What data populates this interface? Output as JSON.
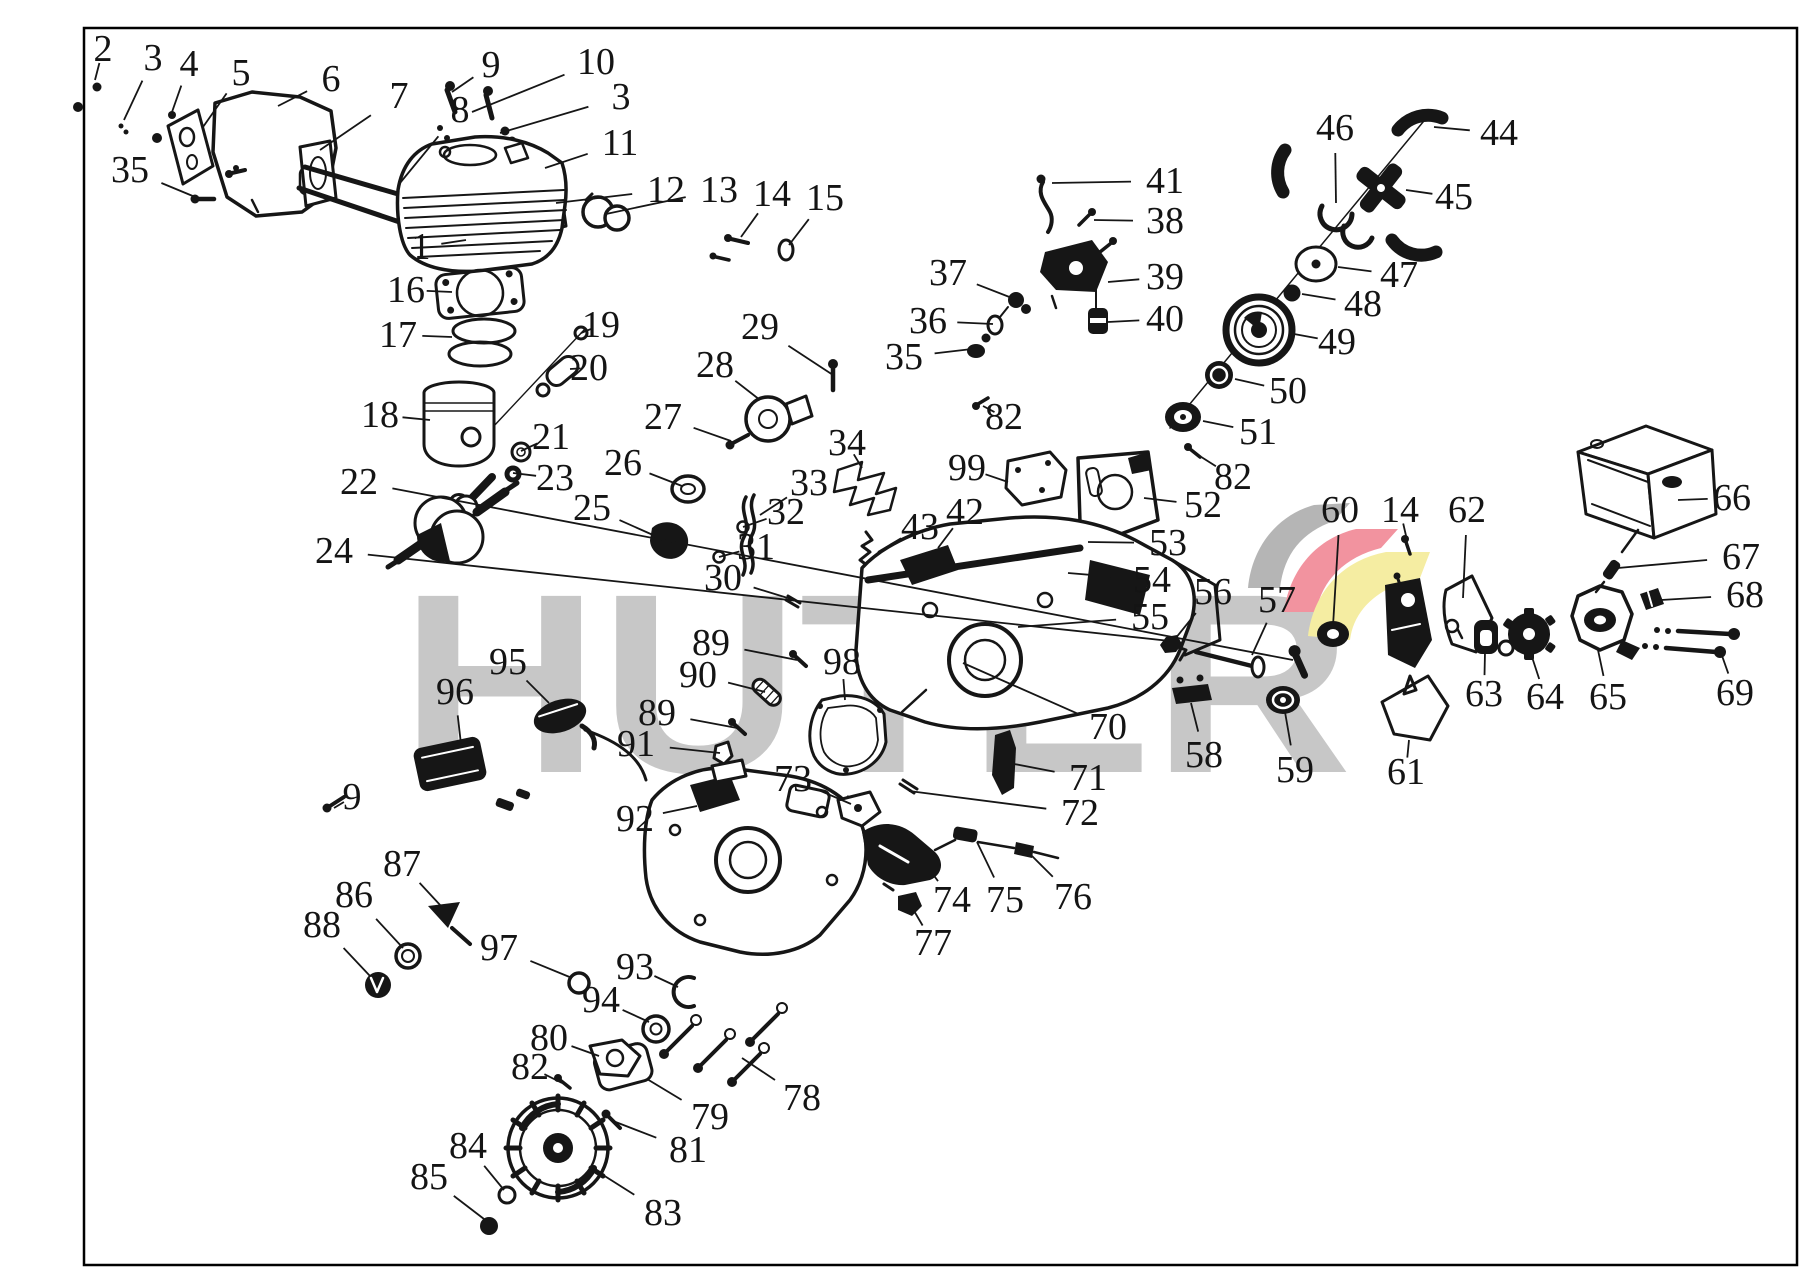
{
  "watermark": {
    "text": "HUTER",
    "letter_color": "#c7c7c7",
    "logo_gray": "#b5b5b5",
    "logo_red": "#f2939f",
    "logo_yellow": "#f5eda2"
  },
  "frame_color": "#000000",
  "line_color": "#161616",
  "callouts": [
    {
      "n": "2",
      "x": 103,
      "y": 49,
      "tx": 95,
      "ty": 80
    },
    {
      "n": "3",
      "x": 153,
      "y": 58,
      "tx": 124,
      "ty": 120
    },
    {
      "n": "4",
      "x": 189,
      "y": 64,
      "tx": 172,
      "ty": 112
    },
    {
      "n": "5",
      "x": 241,
      "y": 73,
      "tx": 203,
      "ty": 127
    },
    {
      "n": "6",
      "x": 331,
      "y": 79,
      "tx": 278,
      "ty": 106
    },
    {
      "n": "7",
      "x": 399,
      "y": 96,
      "tx": 320,
      "ty": 150
    },
    {
      "n": "8",
      "x": 460,
      "y": 110,
      "tx": 400,
      "ty": 183
    },
    {
      "n": "9",
      "x": 491,
      "y": 65,
      "tx": 452,
      "ty": 92
    },
    {
      "n": "10",
      "x": 596,
      "y": 62,
      "tx": 472,
      "ty": 112
    },
    {
      "n": "3",
      "x": 621,
      "y": 97,
      "tx": 500,
      "ty": 133
    },
    {
      "n": "11",
      "x": 620,
      "y": 143,
      "tx": 545,
      "ty": 168
    },
    {
      "n": "12",
      "x": 666,
      "y": 190,
      "tx": 556,
      "ty": 203
    },
    {
      "n": "13",
      "x": 719,
      "y": 190,
      "tx": 606,
      "ty": 214
    },
    {
      "n": "14",
      "x": 772,
      "y": 194,
      "tx": 741,
      "ty": 237
    },
    {
      "n": "15",
      "x": 825,
      "y": 198,
      "tx": 789,
      "ty": 245
    },
    {
      "n": "35",
      "x": 130,
      "y": 170,
      "tx": 200,
      "ty": 199
    },
    {
      "n": "1",
      "x": 421,
      "y": 247,
      "tx": 466,
      "ty": 240
    },
    {
      "n": "16",
      "x": 406,
      "y": 290,
      "tx": 452,
      "ty": 292
    },
    {
      "n": "17",
      "x": 398,
      "y": 335,
      "tx": 452,
      "ty": 337
    },
    {
      "n": "19",
      "x": 601,
      "y": 325,
      "tx": 581,
      "ty": 333
    },
    {
      "n": "20",
      "x": 589,
      "y": 368,
      "tx": 570,
      "ty": 369
    },
    {
      "n": "18",
      "x": 380,
      "y": 415,
      "tx": 430,
      "ty": 420
    },
    {
      "n": "21",
      "x": 551,
      "y": 437,
      "tx": 521,
      "ty": 451
    },
    {
      "n": "23",
      "x": 555,
      "y": 478,
      "tx": 513,
      "ty": 473
    },
    {
      "n": "22",
      "x": 359,
      "y": 482,
      "tx": 1293,
      "ty": 660
    },
    {
      "n": "24",
      "x": 334,
      "y": 551,
      "tx": 1170,
      "ty": 641
    },
    {
      "n": "25",
      "x": 592,
      "y": 508,
      "tx": 653,
      "ty": 535
    },
    {
      "n": "26",
      "x": 623,
      "y": 463,
      "tx": 682,
      "ty": 486
    },
    {
      "n": "27",
      "x": 663,
      "y": 417,
      "tx": 731,
      "ty": 441
    },
    {
      "n": "28",
      "x": 715,
      "y": 365,
      "tx": 760,
      "ty": 400
    },
    {
      "n": "29",
      "x": 760,
      "y": 327,
      "tx": 833,
      "ty": 375
    },
    {
      "n": "34",
      "x": 847,
      "y": 443,
      "tx": 862,
      "ty": 468
    },
    {
      "n": "33",
      "x": 809,
      "y": 483,
      "tx": 760,
      "ty": 515
    },
    {
      "n": "32",
      "x": 786,
      "y": 512,
      "tx": 743,
      "ty": 527
    },
    {
      "n": "31",
      "x": 756,
      "y": 547,
      "tx": 719,
      "ty": 557
    },
    {
      "n": "30",
      "x": 723,
      "y": 578,
      "tx": 791,
      "ty": 599
    },
    {
      "n": "43",
      "x": 920,
      "y": 527,
      "tx": 878,
      "ty": 552
    },
    {
      "n": "42",
      "x": 965,
      "y": 512,
      "tx": 938,
      "ty": 548
    },
    {
      "n": "37",
      "x": 948,
      "y": 273,
      "tx": 1012,
      "ty": 298
    },
    {
      "n": "36",
      "x": 928,
      "y": 321,
      "tx": 993,
      "ty": 324
    },
    {
      "n": "35",
      "x": 904,
      "y": 357,
      "tx": 972,
      "ty": 349
    },
    {
      "n": "41",
      "x": 1165,
      "y": 181,
      "tx": 1052,
      "ty": 183
    },
    {
      "n": "38",
      "x": 1165,
      "y": 221,
      "tx": 1094,
      "ty": 220
    },
    {
      "n": "39",
      "x": 1165,
      "y": 277,
      "tx": 1108,
      "ty": 282
    },
    {
      "n": "40",
      "x": 1165,
      "y": 319,
      "tx": 1108,
      "ty": 322
    },
    {
      "n": "82",
      "x": 1004,
      "y": 417,
      "tx": 983,
      "ty": 406
    },
    {
      "n": "99",
      "x": 967,
      "y": 468,
      "tx": 1008,
      "ty": 482
    },
    {
      "n": "46",
      "x": 1335,
      "y": 128,
      "tx": 1336,
      "ty": 203
    },
    {
      "n": "44",
      "x": 1499,
      "y": 133,
      "tx": 1434,
      "ty": 127
    },
    {
      "n": "45",
      "x": 1454,
      "y": 197,
      "tx": 1406,
      "ty": 190
    },
    {
      "n": "47",
      "x": 1399,
      "y": 275,
      "tx": 1338,
      "ty": 267
    },
    {
      "n": "48",
      "x": 1363,
      "y": 304,
      "tx": 1302,
      "ty": 294
    },
    {
      "n": "49",
      "x": 1337,
      "y": 342,
      "tx": 1294,
      "ty": 334
    },
    {
      "n": "50",
      "x": 1288,
      "y": 391,
      "tx": 1235,
      "ty": 379
    },
    {
      "n": "51",
      "x": 1258,
      "y": 432,
      "tx": 1203,
      "ty": 421
    },
    {
      "n": "82",
      "x": 1233,
      "y": 477,
      "tx": 1195,
      "ty": 453
    },
    {
      "n": "52",
      "x": 1203,
      "y": 505,
      "tx": 1144,
      "ty": 498
    },
    {
      "n": "53",
      "x": 1168,
      "y": 543,
      "tx": 1088,
      "ty": 542
    },
    {
      "n": "54",
      "x": 1152,
      "y": 580,
      "tx": 1068,
      "ty": 573
    },
    {
      "n": "55",
      "x": 1150,
      "y": 617,
      "tx": 1018,
      "ty": 627
    },
    {
      "n": "56",
      "x": 1213,
      "y": 592,
      "tx": 1175,
      "ty": 639
    },
    {
      "n": "57",
      "x": 1277,
      "y": 600,
      "tx": 1252,
      "ty": 655
    },
    {
      "n": "60",
      "x": 1340,
      "y": 510,
      "tx": 1333,
      "ty": 626
    },
    {
      "n": "14",
      "x": 1400,
      "y": 510,
      "tx": 1407,
      "ty": 540
    },
    {
      "n": "62",
      "x": 1467,
      "y": 510,
      "tx": 1463,
      "ty": 598
    },
    {
      "n": "66",
      "x": 1732,
      "y": 498,
      "tx": 1678,
      "ty": 500
    },
    {
      "n": "67",
      "x": 1741,
      "y": 557,
      "tx": 1618,
      "ty": 568
    },
    {
      "n": "68",
      "x": 1745,
      "y": 595,
      "tx": 1661,
      "ty": 600
    },
    {
      "n": "69",
      "x": 1735,
      "y": 693,
      "tx": 1720,
      "ty": 650
    },
    {
      "n": "63",
      "x": 1484,
      "y": 694,
      "tx": 1485,
      "ty": 652
    },
    {
      "n": "64",
      "x": 1545,
      "y": 697,
      "tx": 1532,
      "ty": 657
    },
    {
      "n": "65",
      "x": 1608,
      "y": 697,
      "tx": 1598,
      "ty": 650
    },
    {
      "n": "59",
      "x": 1295,
      "y": 770,
      "tx": 1285,
      "ty": 712
    },
    {
      "n": "61",
      "x": 1406,
      "y": 772,
      "tx": 1409,
      "ty": 740
    },
    {
      "n": "58",
      "x": 1204,
      "y": 755,
      "tx": 1191,
      "ty": 703
    },
    {
      "n": "70",
      "x": 1108,
      "y": 727,
      "tx": 963,
      "ty": 663
    },
    {
      "n": "71",
      "x": 1088,
      "y": 778,
      "tx": 1009,
      "ty": 763
    },
    {
      "n": "72",
      "x": 1080,
      "y": 813,
      "tx": 909,
      "ty": 791
    },
    {
      "n": "89",
      "x": 711,
      "y": 643,
      "tx": 797,
      "ty": 660
    },
    {
      "n": "90",
      "x": 698,
      "y": 675,
      "tx": 765,
      "ty": 692
    },
    {
      "n": "89",
      "x": 657,
      "y": 713,
      "tx": 737,
      "ty": 728
    },
    {
      "n": "91",
      "x": 636,
      "y": 744,
      "tx": 720,
      "ty": 753
    },
    {
      "n": "98",
      "x": 842,
      "y": 662,
      "tx": 845,
      "ty": 700
    },
    {
      "n": "95",
      "x": 508,
      "y": 662,
      "tx": 549,
      "ty": 703
    },
    {
      "n": "96",
      "x": 455,
      "y": 692,
      "tx": 461,
      "ty": 744
    },
    {
      "n": "9",
      "x": 352,
      "y": 797,
      "tx": 334,
      "ty": 808
    },
    {
      "n": "73",
      "x": 793,
      "y": 779,
      "tx": 851,
      "ty": 804
    },
    {
      "n": "92",
      "x": 635,
      "y": 819,
      "tx": 697,
      "ty": 806
    },
    {
      "n": "87",
      "x": 402,
      "y": 864,
      "tx": 441,
      "ty": 906
    },
    {
      "n": "86",
      "x": 354,
      "y": 895,
      "tx": 403,
      "ty": 948
    },
    {
      "n": "88",
      "x": 322,
      "y": 925,
      "tx": 370,
      "ty": 976
    },
    {
      "n": "97",
      "x": 499,
      "y": 948,
      "tx": 572,
      "ty": 978
    },
    {
      "n": "93",
      "x": 635,
      "y": 967,
      "tx": 678,
      "ty": 987
    },
    {
      "n": "94",
      "x": 601,
      "y": 1000,
      "tx": 649,
      "ty": 1022
    },
    {
      "n": "80",
      "x": 549,
      "y": 1038,
      "tx": 599,
      "ty": 1056
    },
    {
      "n": "82",
      "x": 530,
      "y": 1067,
      "tx": 562,
      "ty": 1083
    },
    {
      "n": "74",
      "x": 952,
      "y": 900,
      "tx": 921,
      "ty": 858
    },
    {
      "n": "75",
      "x": 1005,
      "y": 900,
      "tx": 977,
      "ty": 842
    },
    {
      "n": "76",
      "x": 1073,
      "y": 897,
      "tx": 1028,
      "ty": 852
    },
    {
      "n": "77",
      "x": 933,
      "y": 943,
      "tx": 910,
      "ty": 904
    },
    {
      "n": "78",
      "x": 802,
      "y": 1098,
      "tx": 742,
      "ty": 1058
    },
    {
      "n": "79",
      "x": 710,
      "y": 1117,
      "tx": 647,
      "ty": 1079
    },
    {
      "n": "81",
      "x": 688,
      "y": 1150,
      "tx": 613,
      "ty": 1121
    },
    {
      "n": "84",
      "x": 468,
      "y": 1146,
      "tx": 504,
      "ty": 1190
    },
    {
      "n": "85",
      "x": 429,
      "y": 1177,
      "tx": 484,
      "ty": 1219
    },
    {
      "n": "83",
      "x": 663,
      "y": 1213,
      "tx": 592,
      "ty": 1168
    }
  ]
}
